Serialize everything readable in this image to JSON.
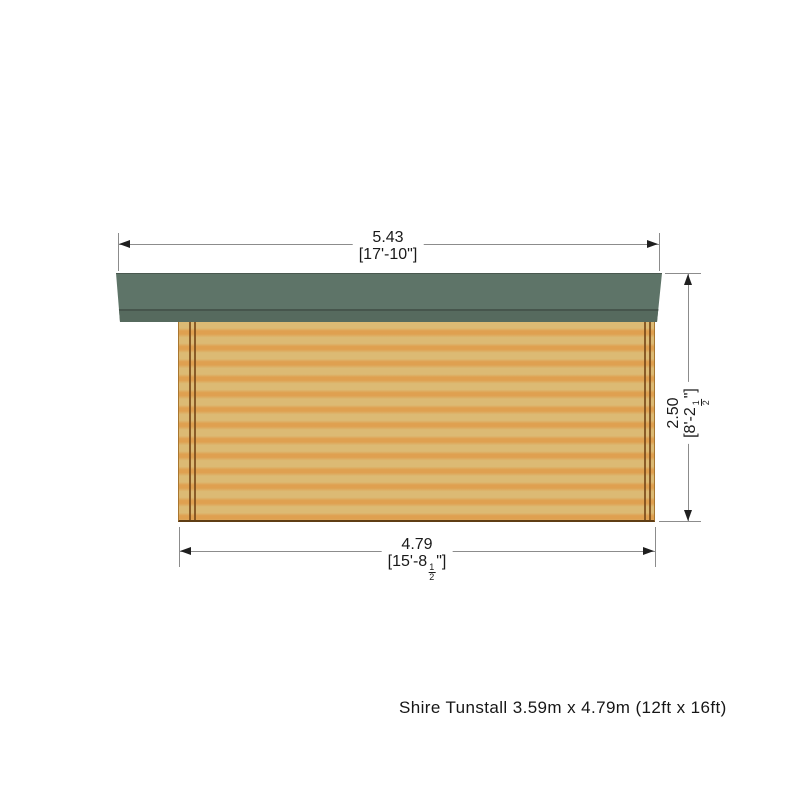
{
  "diagram": {
    "type": "product-elevation-drawing",
    "product_caption": "Shire Tunstall 3.59m x 4.79m (12ft x 16ft)",
    "dimensions": {
      "roof_width": {
        "metric": "5.43",
        "imperial": "[17'-10\"]"
      },
      "wall_height": {
        "metric": "2.50",
        "imperial_open": "[8'-2",
        "frac_num": "1",
        "frac_den": "2",
        "imperial_close": "\"]"
      },
      "wall_width": {
        "metric": "4.79",
        "imperial_open": "[15'-8",
        "frac_num": "1",
        "frac_den": "2",
        "imperial_close": "\"]"
      }
    },
    "colors": {
      "roof_green": "#5e7468",
      "roof_fascia_green": "#566a5e",
      "roof_edge_dark": "#46554c",
      "wall_tan": "#dcba74",
      "wall_orange": "#dfa050",
      "corner_log_line": "#7a4a1a",
      "dimension_line_gray": "#8c8c8c",
      "text_color": "#1a1a1a"
    }
  }
}
